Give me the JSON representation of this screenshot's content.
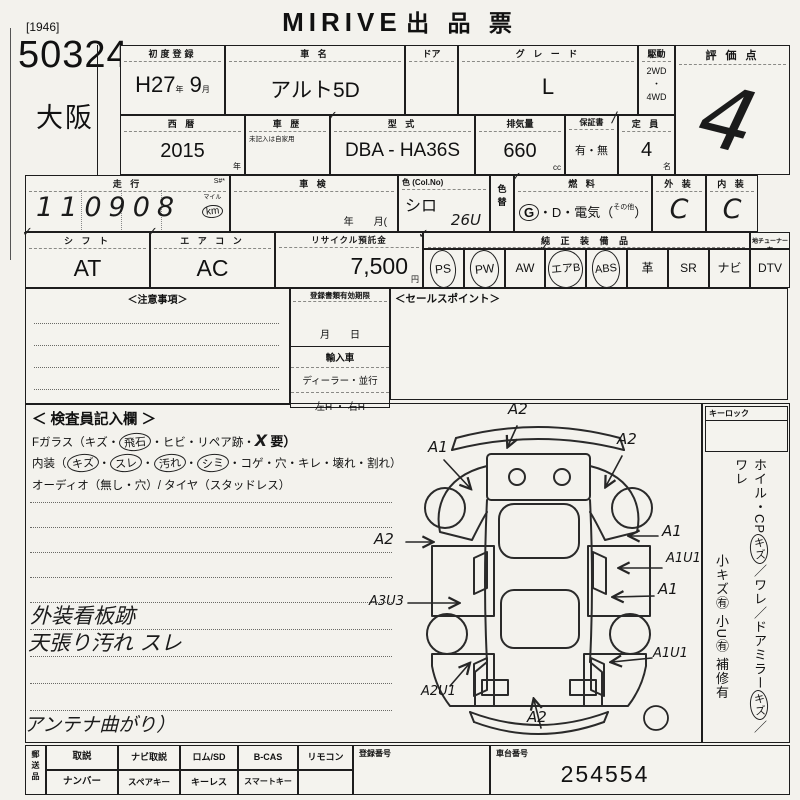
{
  "page": {
    "tag": "[1946]",
    "lot": "50324",
    "site": "大阪",
    "title_latin": "MIRIVE",
    "title_jp": "出 品 票",
    "check": "✓",
    "slash": "/"
  },
  "row1": {
    "first_reg": {
      "label": "初度登録",
      "era": "H27",
      "unit_era": "年",
      "month": "9",
      "unit_month": "月"
    },
    "car_name": {
      "label": "車 名",
      "value": "アルト5D"
    },
    "door": {
      "label": "ドア"
    },
    "grade": {
      "label": "グ レ ー ド",
      "value": "L"
    },
    "drive": {
      "label": "駆動",
      "opt1": "2WD",
      "dot": "・",
      "opt2": "4WD"
    },
    "score": {
      "label": "評 価 点",
      "value": "4"
    }
  },
  "row2": {
    "year": {
      "label": "西 暦",
      "value": "2015",
      "unit": "年"
    },
    "history": {
      "label": "車 歴",
      "note": "未記入は自家用"
    },
    "model": {
      "label": "型 式",
      "value": "DBA - HA36S"
    },
    "disp": {
      "label": "排気量",
      "value": "660",
      "unit": "cc"
    },
    "warranty": {
      "label": "保証書",
      "value": "有・無"
    },
    "capacity": {
      "label": "定 員",
      "value": "4",
      "unit": "名"
    }
  },
  "row3": {
    "mileage": {
      "label": "走 行",
      "marks": "S#*",
      "value": "110908",
      "unit_top": "マイル",
      "unit": "km"
    },
    "inspection": {
      "label": "車 検",
      "sub": "年　　月("
    },
    "color": {
      "label": "色 (Col.No)",
      "value": "シロ",
      "code": "26U"
    },
    "color_change": {
      "label": "色替"
    },
    "fuel": {
      "label": "燃 料",
      "g": "G",
      "mid": "・D・電気（",
      "other": "その他",
      "close": "）"
    },
    "exterior": {
      "label": "外 装",
      "value": "C"
    },
    "interior": {
      "label": "内 装",
      "value": "C"
    }
  },
  "row4": {
    "shift": {
      "label": "シ フ ト",
      "value": "AT"
    },
    "aircon": {
      "label": "エ ア コ ン",
      "value": "AC"
    },
    "recycle": {
      "label": "リサイクル預託金",
      "value": "7,500",
      "unit": "円"
    },
    "equipment": {
      "label": "純 正 装 備 品",
      "tuner": "地チューナー有",
      "items": [
        {
          "label": "PS",
          "circled": true
        },
        {
          "label": "PW",
          "circled": true
        },
        {
          "label": "AW",
          "circled": false
        },
        {
          "label": "エアB",
          "circled": true
        },
        {
          "label": "ABS",
          "circled": true
        },
        {
          "label": "革",
          "circled": false
        },
        {
          "label": "SR",
          "circled": false
        },
        {
          "label": "ナビ",
          "circled": false
        },
        {
          "label": "DTV",
          "circled": false
        }
      ]
    }
  },
  "row5": {
    "notes_label": "＜注意事項＞",
    "docs": {
      "label": "登録書類有効期限",
      "date": "月　　日",
      "import_label": "輸入車",
      "dealer": "ディーラー・並行",
      "handle": "左H ・ 右H"
    },
    "sales_label": "＜セールスポイント＞"
  },
  "inspector": {
    "title": "＜ 検査員記入欄 ＞",
    "fglass": {
      "pre": "Fガラス（キズ・",
      "circled": "飛石",
      "mid": "・ヒビ・リペア跡・",
      "x": "X",
      "post": "要）"
    },
    "interior_line": {
      "pre": "内装（",
      "c1": "キズ",
      "sep": "・",
      "c2": "スレ",
      "c3": "汚れ",
      "c4": "シミ",
      "post": "・コゲ・穴・キレ・壊れ・割れ）"
    },
    "audio_line": "オーディオ（無し・穴）/ タイヤ（スタッドレス）",
    "notes": [
      "外装看板跡",
      "天張り汚れ スレ",
      "アンテナ曲がり）"
    ]
  },
  "diagram": {
    "annotations": [
      "A2",
      "A1",
      "A2",
      "A2",
      "A1",
      "A1U1",
      "A1",
      "A3U3",
      "A1U1",
      "A2U1",
      "A2"
    ]
  },
  "sidebar": {
    "keylock": "キーロック",
    "wheel": {
      "p1": "ホイル・CP",
      "c1": "キズ",
      "p2": "／ワレ／ドアミラー",
      "c2": "キズ",
      "p3": "／ワレ"
    },
    "small": "小キズ㊒ 小U㊒ 補修有"
  },
  "bottom": {
    "ship": "郵送品",
    "top": [
      "取説",
      "ナビ取説",
      "ロム/SD",
      "B-CAS",
      "リモコン"
    ],
    "bottom": [
      "ナンバー",
      "スペアキー",
      "キーレス",
      "スマートキー"
    ],
    "reg_label": "登録番号",
    "chassis_label": "車台番号",
    "chassis_value": "254554"
  }
}
